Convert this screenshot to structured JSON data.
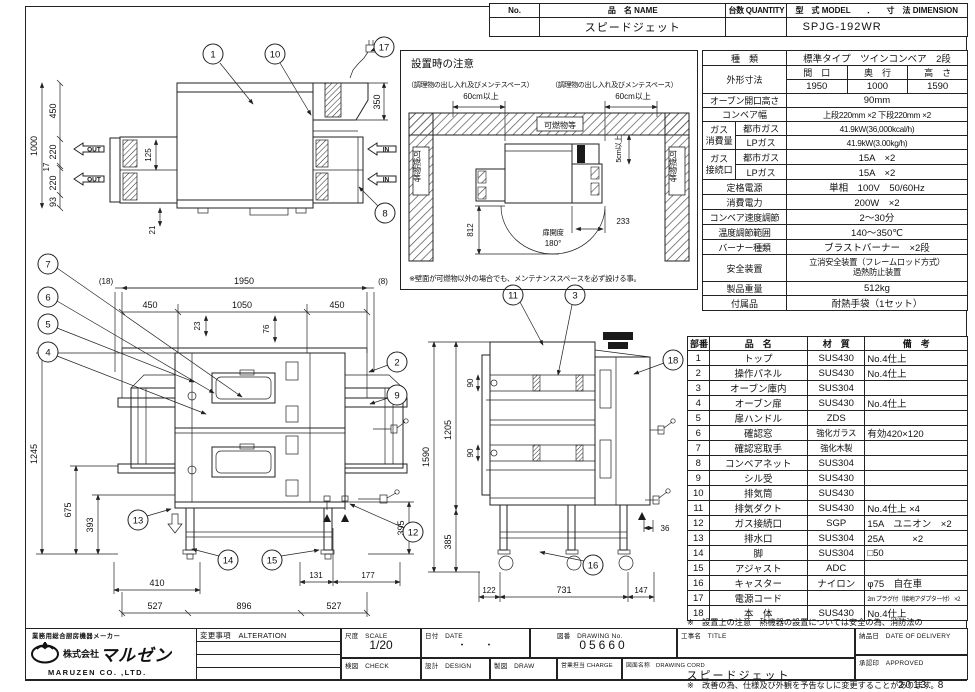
{
  "header": {
    "no_label": "No.",
    "name_label": "品　名 NAME",
    "qty_label": "台数 QUANTITY",
    "model_dim_label": "型　式 MODEL　　．　　寸　法 DIMENSION",
    "name_value": "スピードジェット",
    "model_value": "SPJG-192WR"
  },
  "install": {
    "title": "設置時の注意",
    "maint_left": "（調理物の出し入れ及びメンテスペース）",
    "maint_right": "（調理物の出し入れ及びメンテスペース）",
    "clr_left": "60cm以上",
    "clr_right": "60cm以上",
    "comb_top": "可燃物等",
    "comb_left": "可燃物等",
    "comb_right": "可燃物等",
    "clr_back": "5cm以上",
    "d812": "812",
    "d233": "233",
    "door_label": "扉開度",
    "door_angle": "180°",
    "note": "※壁面が可燃物以外の場合でも、メンテナンススペースを必ず設ける事。"
  },
  "spec": {
    "type_label": "種　類",
    "type_value": "標準タイプ　ツインコンベア　2段",
    "outer_label": "外形寸法",
    "width_label": "間　口",
    "depth_label": "奥　行",
    "height_label": "高　さ",
    "width_value": "1950",
    "depth_value": "1000",
    "height_value": "1590",
    "opening_label": "オーブン開口高さ",
    "opening_value": "90mm",
    "conveyor_label": "コンベア幅",
    "conveyor_value": "上段220mm ×2 下段220mm ×2",
    "gas_label1": "ガス",
    "gas_label2": "消費量",
    "gas_city_label": "都市ガス",
    "gas_city_value": "41.9kW(36,000kcal/h)",
    "gas_lp_label": "LPガス",
    "gas_lp_value": "41.9kW(3.00kg/h)",
    "conn_label1": "ガス",
    "conn_label2": "接続口",
    "conn_city_label": "都市ガス",
    "conn_city_value": "15A　×2",
    "conn_lp_label": "LPガス",
    "conn_lp_value": "15A　×2",
    "power_label": "定格電源",
    "power_value": "単相　100V　50/60Hz",
    "elec_label": "消費電力",
    "elec_value": "200W　×2",
    "speed_label": "コンベア速度調節",
    "speed_value": "2～30分",
    "temp_label": "温度調節範囲",
    "temp_value": "140～350℃",
    "burner_label": "バーナー種類",
    "burner_value": "ブラストバーナー　×2段",
    "safety_label": "安全装置",
    "safety_value1": "立消安全装置（フレームロッド方式）",
    "safety_value2": "過熱防止装置",
    "weight_label": "製品重量",
    "weight_value": "512kg",
    "acc_label": "付属品",
    "acc_value": "耐熱手袋（1セット）"
  },
  "parts": {
    "headers": [
      "部番",
      "品　名",
      "材　質",
      "備　考"
    ],
    "rows": [
      [
        "1",
        "トップ",
        "SUS430",
        "No.4仕上"
      ],
      [
        "2",
        "操作パネル",
        "SUS430",
        "No.4仕上"
      ],
      [
        "3",
        "オーブン庫内",
        "SUS304",
        ""
      ],
      [
        "4",
        "オーブン扉",
        "SUS430",
        "No.4仕上"
      ],
      [
        "5",
        "扉ハンドル",
        "ZDS",
        ""
      ],
      [
        "6",
        "確認窓",
        "強化ガラス",
        "有効420×120"
      ],
      [
        "7",
        "確認窓取手",
        "強化木製",
        ""
      ],
      [
        "8",
        "コンベアネット",
        "SUS304",
        ""
      ],
      [
        "9",
        "シル受",
        "SUS430",
        ""
      ],
      [
        "10",
        "排気筒",
        "SUS430",
        ""
      ],
      [
        "11",
        "排気ダクト",
        "SUS430",
        "No.4仕上 ×4"
      ],
      [
        "12",
        "ガス接続口",
        "SGP",
        "15A　ユニオン　×2"
      ],
      [
        "13",
        "排水口",
        "SUS304",
        "25A　　　×2"
      ],
      [
        "14",
        "脚",
        "SUS304",
        "□50"
      ],
      [
        "15",
        "アジャスト",
        "ADC",
        ""
      ],
      [
        "16",
        "キャスター",
        "ナイロン",
        "φ75　自在車"
      ],
      [
        "17",
        "電源コード",
        "",
        "2m プラグ付（接地アダプター付） ×2"
      ],
      [
        "18",
        "本　体",
        "SUS430",
        "No.4仕上"
      ]
    ]
  },
  "notes": {
    "n1": "※　設置上の注意　熱機器の設置については安全の為、消防法の",
    "n1b": "　　設置基準に従って設置してください。",
    "n2": "※　改善の為、仕様及び外観を予告なしに変更することがあります。"
  },
  "tb": {
    "tagline": "業務用総合厨房機器メーカー",
    "company_prefix": "株式会社",
    "company": "マルゼン",
    "company_en": "MARUZEN  CO. ,LTD.",
    "alteration": "変更事項　ALTERATION",
    "scale_label": "尺度　SCALE",
    "scale_value": "1/20",
    "date_label": "日付　DATE",
    "date_value": "・　　・",
    "dwg_label": "図番　DRAWING No.",
    "dwg_value": "05660",
    "title_label": "工事名　TITLE",
    "check_label": "検図　CHECK",
    "design_label": "設計　DESIGN",
    "draw_label": "製図　DRAW",
    "charge_label": "営業担当 CHARGE",
    "name_label": "図面名称　DRAWING CORD",
    "name_value": "スピードジェット",
    "delivery_label": "納品日　DATE OF DELIVERY",
    "approved_label": "承認印　APPROVED",
    "issue": "2013. 8"
  },
  "views": {
    "plan": {
      "balloons": {
        "b1": "1",
        "b10": "10",
        "b17": "17",
        "b8": "8"
      },
      "dims": {
        "total": "1000",
        "d450": "450",
        "d220a": "220",
        "d17": "17",
        "d220b": "220",
        "d93": "93",
        "d125": "125",
        "d21": "21",
        "d350": "350"
      },
      "out": "OUT",
      "in": "IN"
    },
    "front": {
      "balloons": {
        "b7": "7",
        "b6": "6",
        "b5": "5",
        "b4": "4",
        "b2": "2",
        "b9": "9",
        "b13": "13",
        "b14": "14",
        "b15": "15",
        "b12": "12"
      },
      "dims": {
        "w18": "(18)",
        "w1950": "1950",
        "w8": "(8)",
        "d450a": "450",
        "d1050": "1050",
        "d450b": "450",
        "d23": "23",
        "d76": "76",
        "d1245": "1245",
        "d675": "675",
        "d393": "393",
        "d410": "410",
        "d131": "131",
        "d177": "177",
        "d527a": "527",
        "d896": "896",
        "d527b": "527",
        "d395": "395"
      }
    },
    "side": {
      "balloons": {
        "b11": "11",
        "b3": "3",
        "b18": "18",
        "b16": "16"
      },
      "dims": {
        "d1590": "1590",
        "d1205": "1205",
        "d90a": "90",
        "d90b": "90",
        "d385": "385",
        "d36": "36",
        "d122": "122",
        "d731": "731",
        "d147": "147"
      }
    }
  }
}
